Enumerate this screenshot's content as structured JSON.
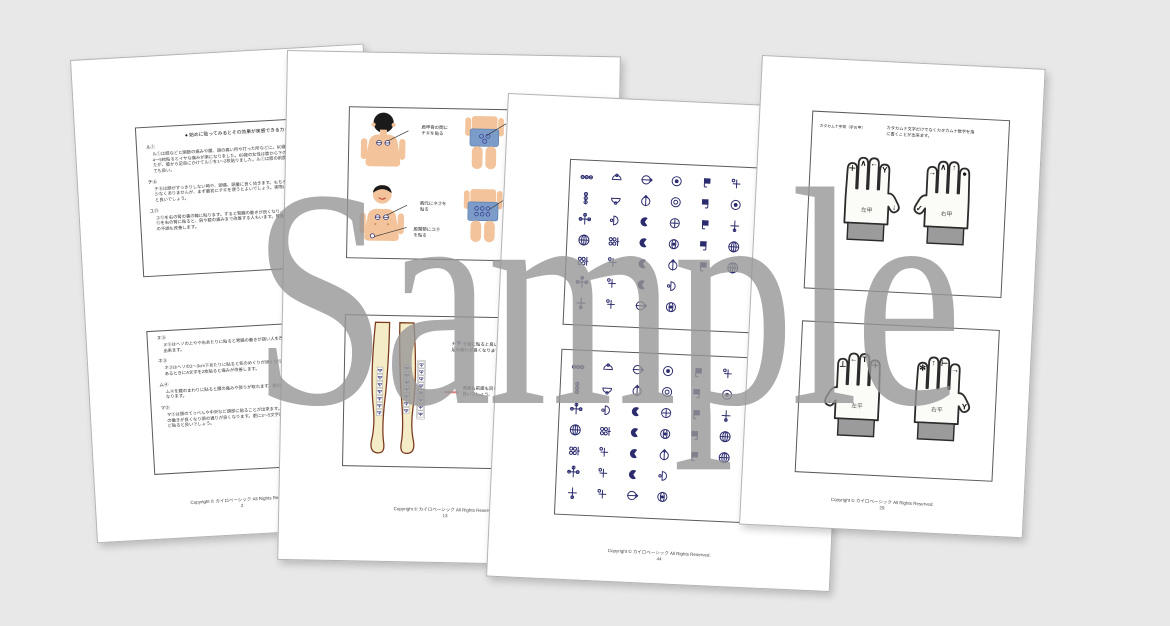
{
  "watermark": "Sample",
  "copyright_line": "Copyright © カイロベーシック All Rights Reserved.",
  "colors": {
    "background": "#e8e8e8",
    "glyph_navy": "#2b2b6e",
    "shorts_blue": "#7b9cc9",
    "skin": "#f3c49c",
    "legs_skin": "#f4ecc6",
    "watermark_gray": "#979797",
    "cuff_gray": "#9b9b9b",
    "red_pointer": "#e08080"
  },
  "pages": {
    "p1": {
      "page_number": "2",
      "box1": {
        "heading": "● 始めに貼ってみるとその効果が実感できるカタカムナ",
        "sections": [
          {
            "label": "ル①",
            "text": "ル①は膝などと関節の痛みや腰、頭の痛い所や打った所などに。60歳の女性はル①を膝の周りに4〜5枚貼るとイヤな痛みが楽になりました。69歳の女性は膝から下の痛みと痺れの症状がありましたが、膝から足首にかけてル①を1〜2枚貼りました。ル①は膝の前面、側面、後面などどこに貼っても良い。"
          },
          {
            "label": "チ⑥",
            "text": "チ⑥は頭がすっきりしない時や、頭痛、頭重に良く効きます。もちろん貼り付け位置が異なる事も少なくありませんが、まず最初にチ⑥を使うとよいでしょう。実際に頭の痛みを感じるときに貼ると良いでしょう。"
          },
          {
            "label": "ユ⑪",
            "text": "ユ⑪を右の腎の裏の輪に貼ります。すると腎臓の動きが良くなり、動きがスムーズになります。ユ⑪を右の腎に貼ると、肩や膝の痛みまで改善する人もいます。腎臓に効くと身体の疲れも取れ、心の不調も改善します。"
          }
        ]
      },
      "box2": {
        "sections": [
          {
            "label": "ヌ⑨",
            "text": "ヌ⑨はヘソの上やや右あたりに貼ると胃腸の働きが弱い人を改善することが出来ます。"
          },
          {
            "label": "ネ③",
            "text": "ネ③はヘソの2〜3cm下あたりに貼ると気のめぐりが良くなり、右胸の心積があるときにA文字を2枚貼ると痛みが改善します。"
          },
          {
            "label": "ム④",
            "text": "ム④を腰のまわりに貼ると腰の痛みや張りが取れます。腰の動きもスムーズになります。"
          },
          {
            "label": "マ⑤",
            "text": "マ⑤は頭のてっぺんや中央など頭部に貼ることが出来ます。脳の働きが良くなり頭の通りが良くなります。更に3〜5文字ほど貼ると良いでしょう。"
          }
        ],
        "note": "※1周\n腰の痛みが悪い方は、まず最初に腰へ貼ると楽になり、絵を貼ると痛みが消えました。"
      }
    },
    "p2": {
      "page_number": "13",
      "box1": {
        "callout_a": "肩甲骨の間に\nチ⑥を貼る",
        "callout_c1": "胸元にネ③を\n貼る",
        "callout_c2": "股関節にユ⑪\nを貼る"
      },
      "box2": {
        "text1_prefix": "ナ",
        "text1": "を縦に貼ると良いでしょう。\n足の疲れが良くなります。",
        "text2": "側面も前面も同じようにして\n良いでしょう。"
      }
    },
    "p3": {
      "page_number": "44",
      "rows": [
        [
          "hchain",
          "halfup",
          "arrowright",
          "targetdot",
          "flagr",
          "plusdot",
          "bowl",
          "bowldot"
        ],
        [
          "vchain",
          "halfdown",
          "arrowup",
          "ringring",
          "flagl",
          "targetdot",
          "bowldot",
          "halfup"
        ],
        [
          "crossdots",
          "halfright",
          "crescent",
          "circlecross",
          "flagr",
          "plusv",
          "bowl",
          "halfdown"
        ],
        [
          "globe",
          "griddots",
          "crescent",
          "eye",
          "flagl",
          "globe",
          "bowldot",
          "crescent"
        ],
        [
          "griddots",
          "plusdot",
          "crescent",
          "arrowup",
          "flagr",
          "globe",
          "plusv",
          "eye"
        ],
        [
          "crossdots",
          "plusdot",
          "crescent",
          "halfright"
        ],
        [
          "plusv",
          "plusdot",
          "arrowright",
          "eye"
        ]
      ]
    },
    "p4": {
      "page_number": "29",
      "box1": {
        "corner_label": "カタカムナ手袋（手の甲）",
        "description": "カタカムナ文字だけでなくカタカムナ数字を指\nに書くことが出来ます。",
        "left": {
          "label": "左甲",
          "thumb": "↓",
          "fingers": [
            "＋",
            "∧",
            "←",
            "Y"
          ]
        },
        "right": {
          "label": "右甲",
          "thumb": "✓",
          "fingers": [
            "→",
            "∧",
            "↑",
            "●"
          ]
        }
      },
      "box2": {
        "left": {
          "label": "左平",
          "thumb": "↓",
          "fingers": [
            "⊥",
            "←",
            "T",
            "＋"
          ]
        },
        "right": {
          "label": "右平",
          "thumb": "Y",
          "fingers": [
            "✻",
            "↑",
            "⊢",
            "→"
          ]
        }
      }
    }
  }
}
